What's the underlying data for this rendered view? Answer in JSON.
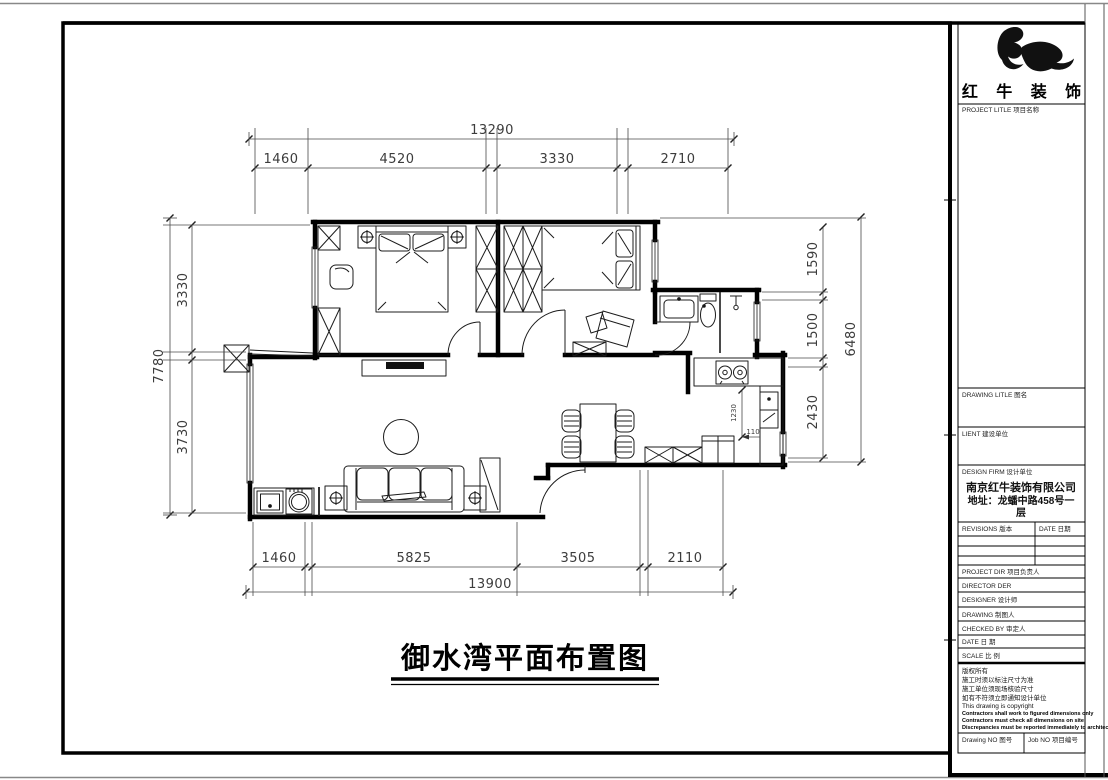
{
  "page": {
    "title": "御水湾平面布置图"
  },
  "logo": {
    "company": "红 牛 装 饰"
  },
  "dimensions": {
    "top": {
      "total": "13290",
      "segments": [
        "1460",
        "4520",
        "3330",
        "2710"
      ]
    },
    "bottom": {
      "total": "13900",
      "segments": [
        "1460",
        "5825",
        "3505",
        "2110"
      ]
    },
    "left": {
      "total": "7780",
      "segments": [
        "3330",
        "3730"
      ]
    },
    "right": {
      "total": "6480",
      "segments": [
        "1590",
        "1500",
        "2430"
      ]
    },
    "interior": {
      "counter_depth": "1230",
      "offset": "110"
    }
  },
  "titleblock": {
    "project_title_label": "PROJECT LITLE  项目名称",
    "drawing_title_label": "DRAWING LITLE  图名",
    "client_label": "LIENT  建设单位",
    "design_firm_label": "DESIGN FIRM  设计单位",
    "design_firm_name": "南京红牛装饰有限公司",
    "design_firm_addr1": "地址：龙蟠中路458号一",
    "design_firm_addr2": "层",
    "revisions_label": "REVISIONS  版本",
    "date_label": "DATE  日期",
    "project_dir_label": "PROJECT DIR    项目负责人",
    "director_label": "DIRECTOR DER",
    "designer_label": "DESIGNER       设计师",
    "drawing_label": "DRAWING        制图人",
    "checked_label": "CHECKED BY     审定人",
    "date2_label": "DATE           日 期",
    "scale_label": "SCALE          比 例",
    "notes": [
      "版权所有",
      "施工时须以标注尺寸为准",
      "施工单位须现场核验尺寸",
      "如有不符须立即通知设计单位",
      "This drawing is copyright",
      "Contractors shall work to figured dimensions only",
      "Contractors must check all dimensions on site",
      "Discrepancies must be reported immediately to architects"
    ],
    "drawing_no_label": "Drawing NO  图号",
    "job_no_label": "Job NO  项目编号"
  }
}
